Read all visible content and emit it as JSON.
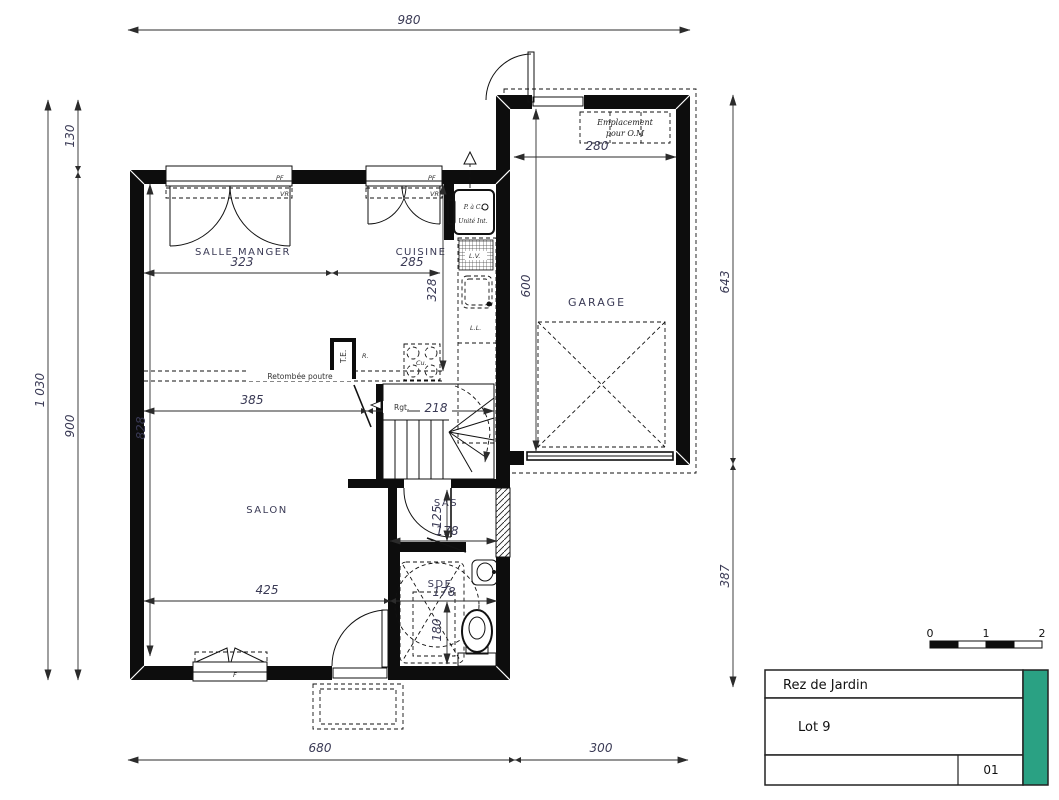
{
  "plan": {
    "rooms": {
      "salle_manger": "SALLE MANGER",
      "cuisine": "CUISINE",
      "garage": "GARAGE",
      "salon": "SALON",
      "sas": "SAS",
      "sde": "SDE"
    },
    "annotations": {
      "om_line1": "Emplacement",
      "om_line2": "pour O.M",
      "beam": "Retombée poutre",
      "pac": "P. à C.",
      "unit_int": "Unité Int.",
      "lv": "L.V.",
      "ll": "L.L.",
      "r": "R.",
      "te": "T.E.",
      "rgt": "Rgt.",
      "cu": "Cu.",
      "pf": "PF",
      "vr": "VR",
      "f": "F"
    },
    "dimensions": {
      "overall_width": "980",
      "overall_height": "1 030",
      "left_upper": "130",
      "left_lower": "900",
      "right_upper": "643",
      "right_lower": "387",
      "bottom_left": "680",
      "bottom_right": "300",
      "dining_width": "323",
      "kitchen_width": "285",
      "kitchen_depth": "328",
      "hall_width": "385",
      "stair_width": "218",
      "living_depth": "828",
      "living_width": "425",
      "sas_depth": "125",
      "sas_width": "178",
      "sde_width": "178",
      "sde_depth": "180",
      "garage_width": "280",
      "garage_depth": "600"
    }
  },
  "title_block": {
    "floor": "Rez de Jardin",
    "lot": "Lot 9",
    "sheet": "01",
    "accent_color": "#2aa183"
  },
  "scale_bar": {
    "labels": [
      "0",
      "1",
      "2"
    ]
  }
}
